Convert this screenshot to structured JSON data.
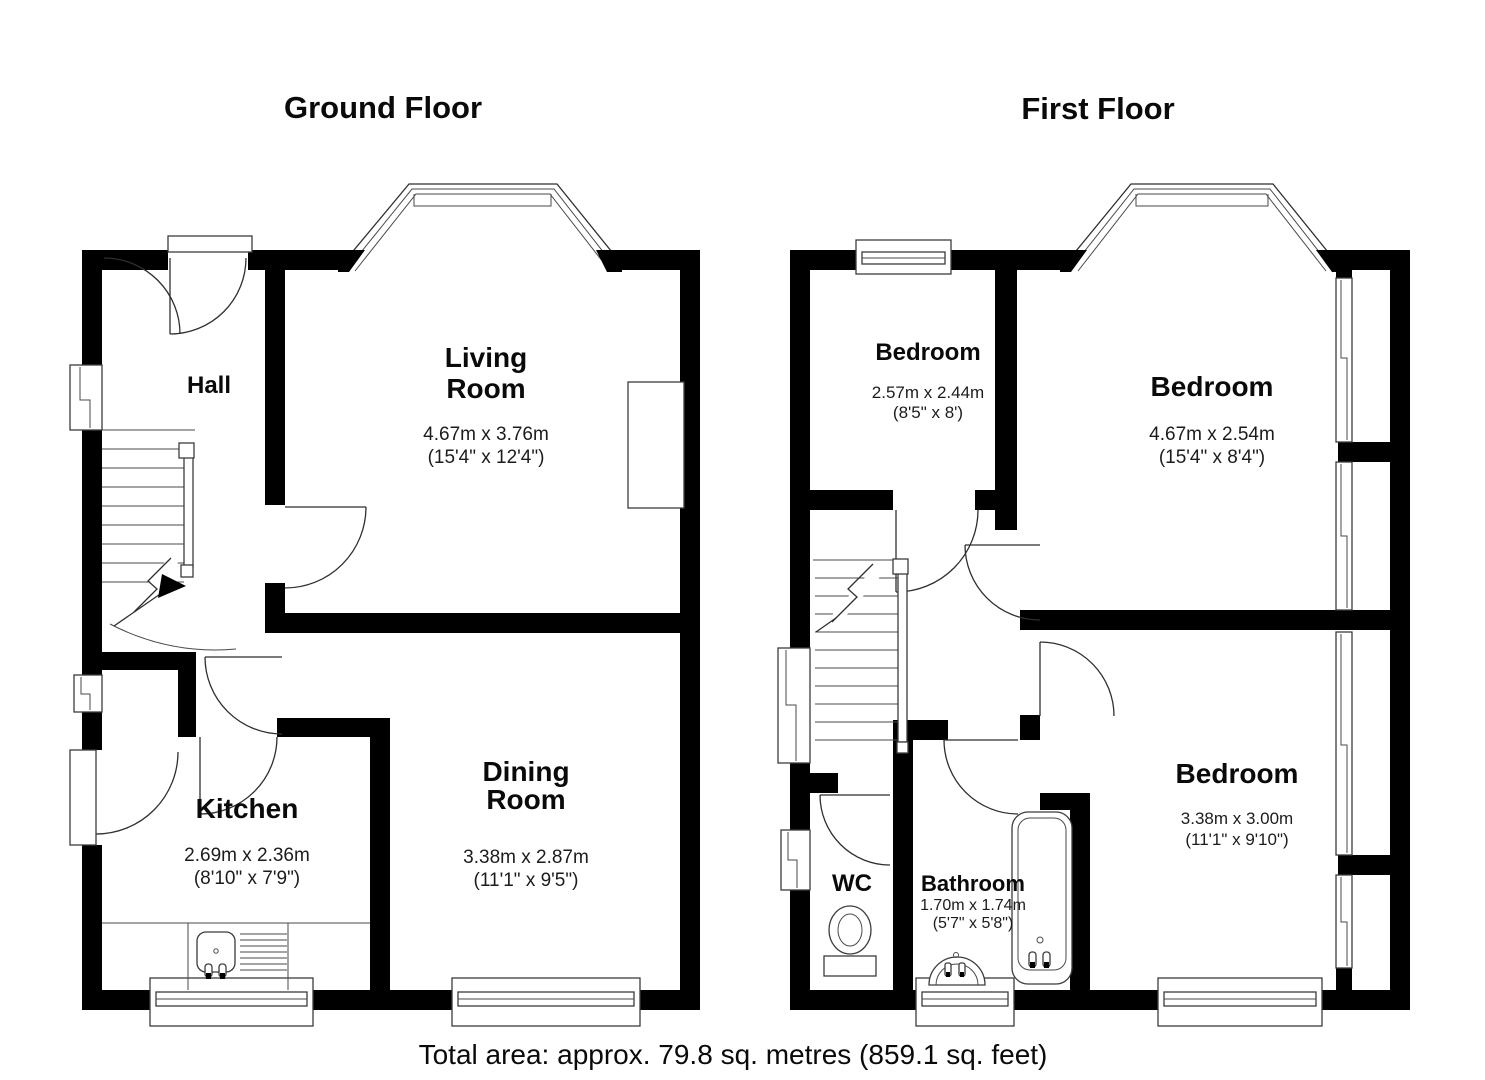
{
  "ground": {
    "title": "Ground Floor",
    "hall": {
      "name": "Hall"
    },
    "living": {
      "name_line1": "Living",
      "name_line2": "Room",
      "metric": "4.67m x 3.76m",
      "imperial": "(15'4\" x 12'4\")"
    },
    "kitchen": {
      "name": "Kitchen",
      "metric": "2.69m x 2.36m",
      "imperial": "(8'10\" x 7'9\")"
    },
    "dining": {
      "name_line1": "Dining",
      "name_line2": "Room",
      "metric": "3.38m x 2.87m",
      "imperial": "(11'1\" x 9'5\")"
    }
  },
  "first": {
    "title": "First Floor",
    "bedroom_small": {
      "name": "Bedroom",
      "metric": "2.57m x 2.44m",
      "imperial": "(8'5\" x 8')"
    },
    "bedroom_front": {
      "name": "Bedroom",
      "metric": "4.67m x 2.54m",
      "imperial": "(15'4\" x 8'4\")"
    },
    "bedroom_back": {
      "name": "Bedroom",
      "metric": "3.38m x 3.00m",
      "imperial": "(11'1\" x 9'10\")"
    },
    "wc": {
      "name": "WC"
    },
    "bathroom": {
      "name": "Bathroom",
      "metric": "1.70m x 1.74m",
      "imperial": "(5'7\" x 5'8\")"
    }
  },
  "footer": {
    "total_area": "Total area: approx. 79.8 sq. metres (859.1 sq. feet)"
  }
}
